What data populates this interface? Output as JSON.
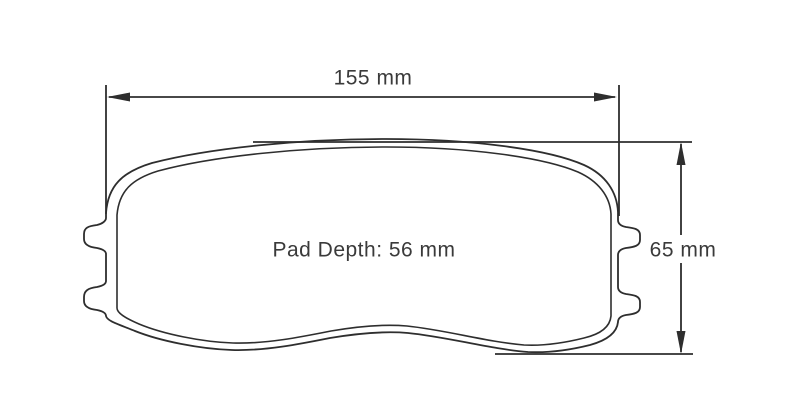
{
  "drawing": {
    "labels": {
      "width": "155 mm",
      "height": "65 mm",
      "pad_depth": "Pad Depth: 56 mm"
    },
    "values": {
      "width_mm": 155,
      "height_mm": 65,
      "pad_depth_mm": 56
    },
    "colors": {
      "line": "#2e2e2e",
      "text": "#3a3a3a",
      "background": "#ffffff"
    }
  }
}
